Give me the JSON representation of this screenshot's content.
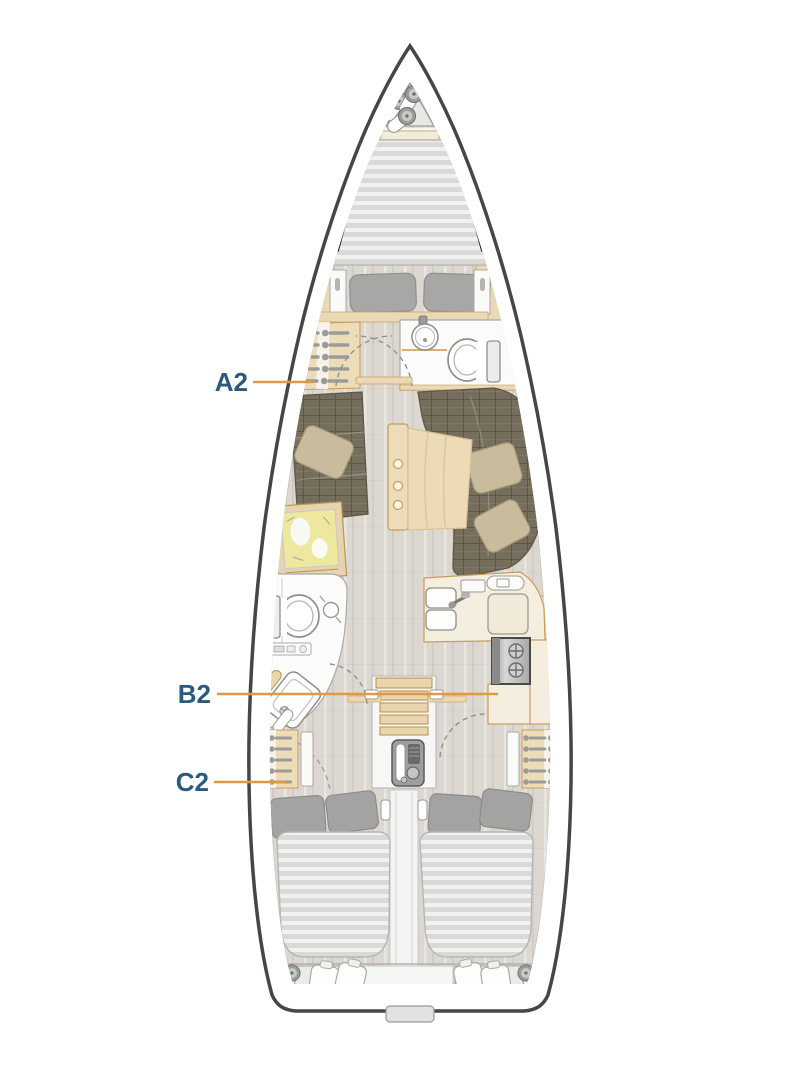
{
  "diagram": {
    "type": "sailing-yacht-interior-layout-top-view",
    "labels": [
      {
        "text": "A2"
      },
      {
        "text": "B2"
      },
      {
        "text": "C2"
      }
    ],
    "colors": {
      "label_text": "#2a5a7d",
      "leader_line": "#dd9a45",
      "hull_outline": "#464646",
      "deck": "#ffffff",
      "floor": "#dcd8d1",
      "joinery_wood": "#ead9b5",
      "joinery_outline": "#c79c5c",
      "counter": "#f4eedf",
      "upholstery": "#766e5c",
      "cushion_tan": "#c9bc9c",
      "mattress": "#d9d9d7",
      "mattress_stripe": "#f1f1ef",
      "pillow_gray": "#a5a5a3",
      "fixture_white": "#fcfcfb",
      "window_black": "#1c1c1c",
      "chart_map": "#eee79e"
    },
    "fixtures": [
      "anchor-locker-fenders",
      "v-berth-double-bed",
      "forward-head-sink",
      "forward-head-toilet",
      "wardrobe-hangers",
      "salon-sofa-port",
      "salon-sofa-starboard",
      "chart-table-with-map",
      "salon-folding-table",
      "aft-head-toilet",
      "aft-head-sink",
      "aft-head-shower",
      "galley-double-sink",
      "galley-stove",
      "galley-refrigerator",
      "companionway-steps",
      "engine",
      "aft-cabin-double-beds",
      "stern-locker-fenders",
      "stern-locker-cushions"
    ]
  }
}
